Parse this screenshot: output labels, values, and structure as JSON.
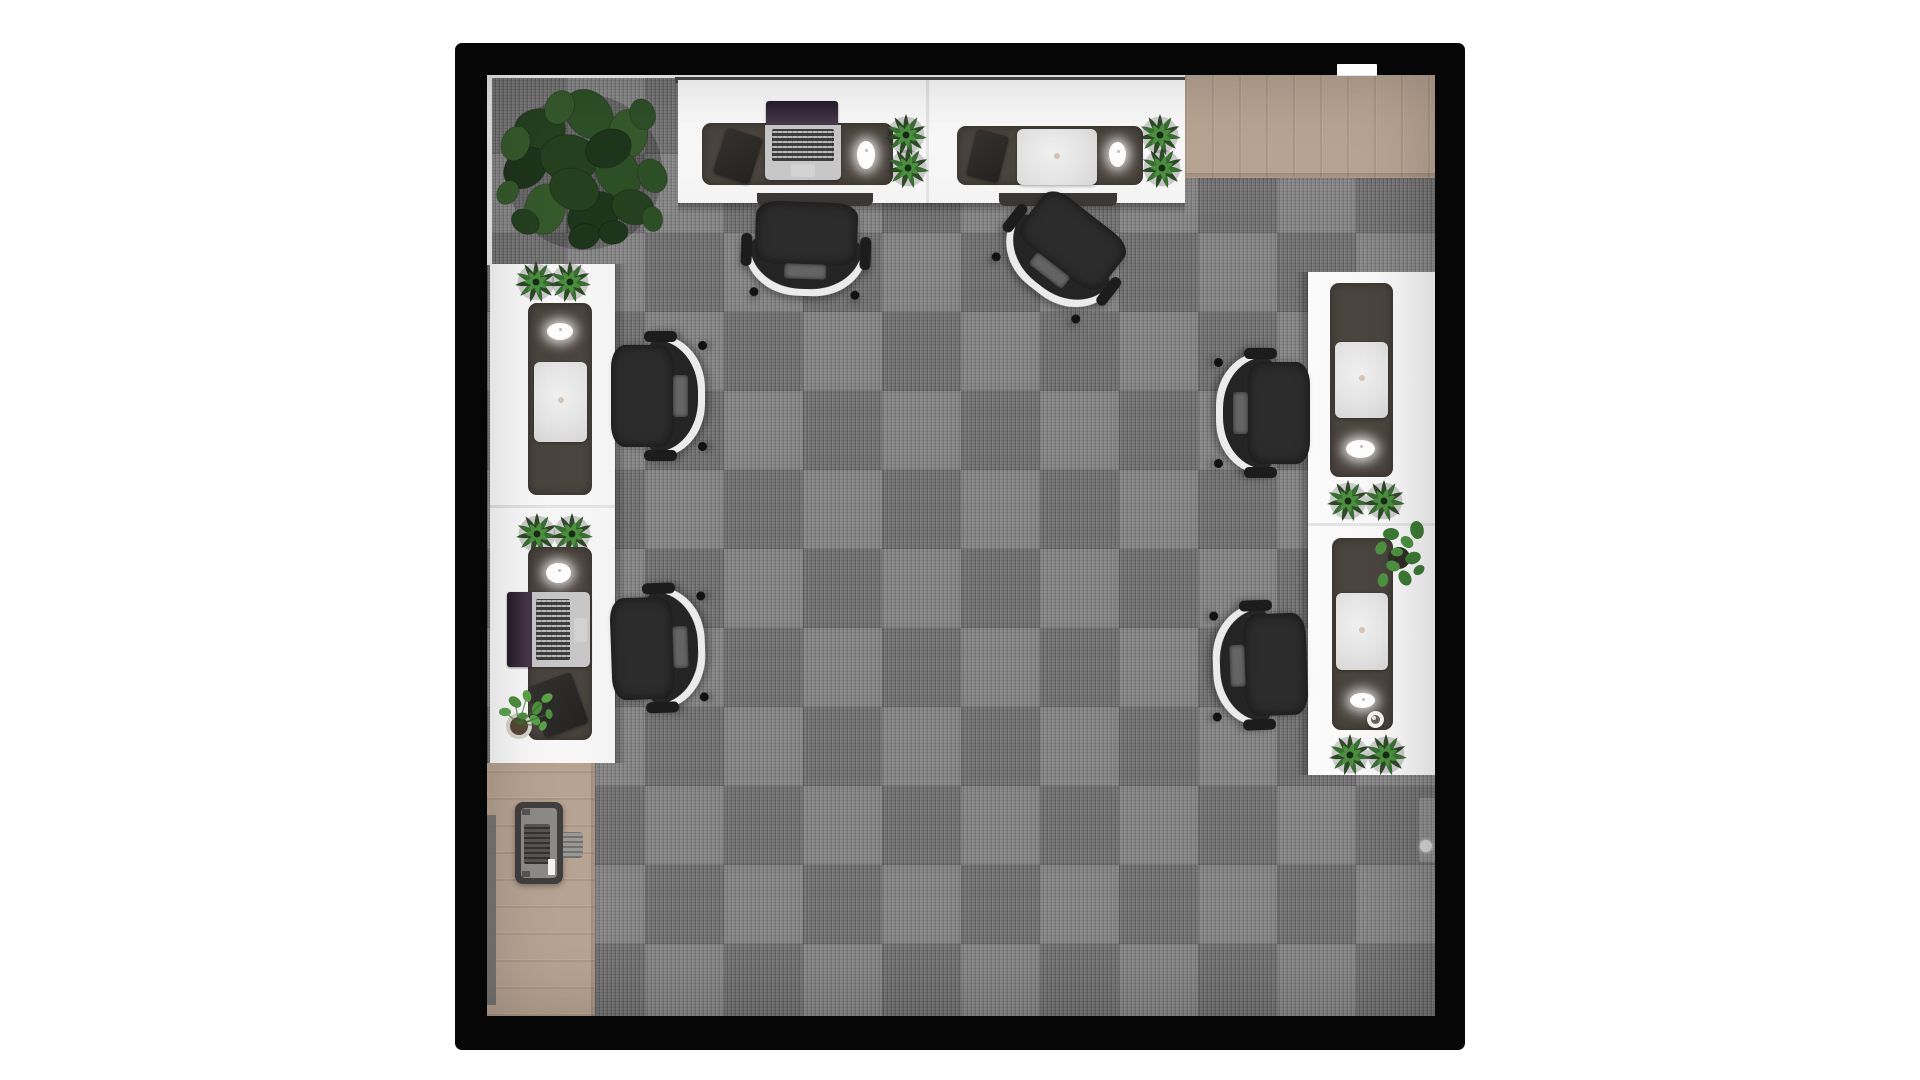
{
  "scene": {
    "title": "Top-down 3D render of a small office room",
    "palette": {
      "wall": "#060606",
      "carpet": "#7d7d7d",
      "wood": "#b7a392",
      "desk": "#f4f4f4",
      "pad": "#4a443e",
      "silver": "#c7c7c7",
      "chair": "#242424",
      "chair_trim": "#ebebeb",
      "leaf_dark": "#2c4a24",
      "leaf_mid": "#377031",
      "leaf_light": "#4c9140",
      "screen": "#3a2f3e"
    },
    "objects": [
      {
        "id": "desk-bank-top",
        "label": "Double workstation desk along top wall",
        "count": 1
      },
      {
        "id": "desk-column-left",
        "label": "Double workstation desk along left wall",
        "count": 1
      },
      {
        "id": "desk-column-right",
        "label": "Double workstation desk along right wall",
        "count": 1
      },
      {
        "id": "office-chair",
        "label": "Black office chair with white shell",
        "count": 6
      },
      {
        "id": "laptop-open",
        "label": "Open laptop with dark screen",
        "count": 2
      },
      {
        "id": "laptop-closed",
        "label": "Closed white laptop",
        "count": 4
      },
      {
        "id": "mouse",
        "label": "White wireless mouse",
        "count": 6
      },
      {
        "id": "notebook",
        "label": "Dark notebook / tablet",
        "count": 3
      },
      {
        "id": "desk-plant",
        "label": "Green desk plant",
        "count": 9
      },
      {
        "id": "large-plant",
        "label": "Large fiddle-leaf floor plant",
        "count": 1
      },
      {
        "id": "floor-plant",
        "label": "Small potted floor plant",
        "count": 1
      },
      {
        "id": "printer",
        "label": "Printer on wood floor",
        "count": 1
      },
      {
        "id": "mug",
        "label": "Coffee mug",
        "count": 1
      },
      {
        "id": "door-handle",
        "label": "Door handle on right wall",
        "count": 1
      },
      {
        "id": "door-gap",
        "label": "Door opening in top wall",
        "count": 1
      },
      {
        "id": "wood-floor",
        "label": "Wood floor patch",
        "count": 2
      }
    ]
  }
}
